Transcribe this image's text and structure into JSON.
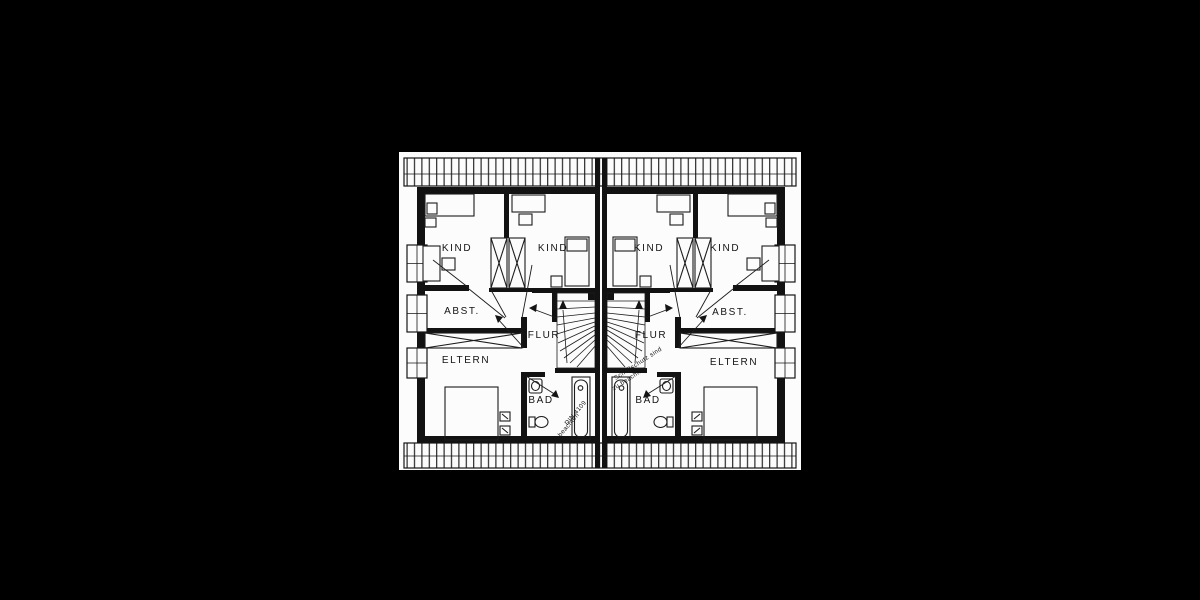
{
  "colors": {
    "background": "#000000",
    "paper": "#fcfcfc",
    "ink": "#141414"
  },
  "floor_plan": {
    "type": "attic-floor-plan-semi-detached-house",
    "left_house": {
      "kind_1": "KIND",
      "kind_2": "KIND",
      "abst": "ABST.",
      "flur": "FLUR",
      "eltern": "ELTERN",
      "bad": "BAD",
      "note_line_1": "DIN 4109",
      "note_line_2": "beachten"
    },
    "right_house": {
      "kind_1": "KIND",
      "kind_2": "KIND",
      "abst": "ABST.",
      "flur": "FLUR",
      "eltern": "ELTERN",
      "bad": "BAD",
      "note_line_1": "Schallschutz sind",
      "note_line_2": "zu beachten"
    }
  }
}
